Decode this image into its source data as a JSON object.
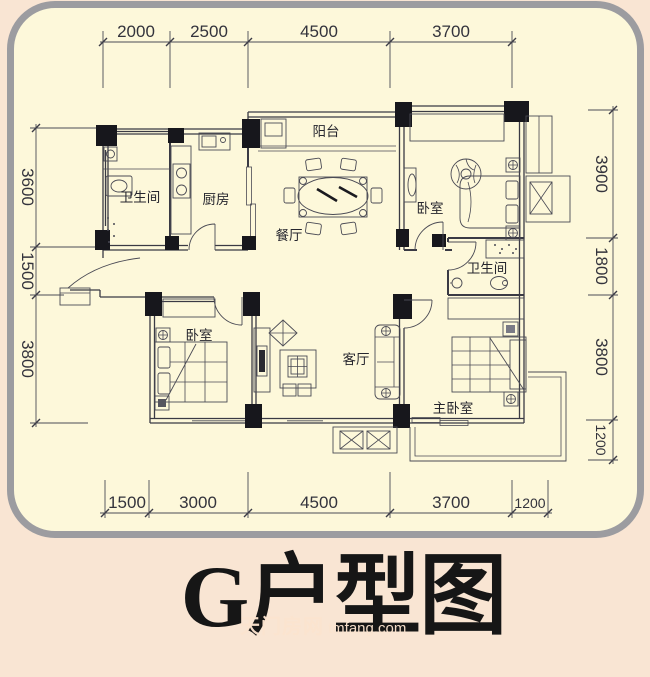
{
  "floorplan": {
    "title": "G户型图",
    "watermark": {
      "site_name": "天门房网",
      "site_url": "tmfang.com"
    },
    "rooms": [
      {
        "id": "balcony",
        "label": "阳台"
      },
      {
        "id": "bathroom-1",
        "label": "卫生间"
      },
      {
        "id": "kitchen",
        "label": "厨房"
      },
      {
        "id": "dining-room",
        "label": "餐厅"
      },
      {
        "id": "bedroom-1",
        "label": "卧室"
      },
      {
        "id": "bathroom-2",
        "label": "卫生间"
      },
      {
        "id": "bedroom-2",
        "label": "卧室"
      },
      {
        "id": "living-room",
        "label": "客厅"
      },
      {
        "id": "master-bedroom",
        "label": "主卧室"
      }
    ],
    "dimensions": {
      "top": [
        "2000",
        "2500",
        "4500",
        "3700"
      ],
      "bottom": [
        "1500",
        "3000",
        "4500",
        "3700",
        "1200"
      ],
      "left": [
        "3600",
        "1500",
        "3800"
      ],
      "right": [
        "3900",
        "1800",
        "3800",
        "1200"
      ]
    },
    "colors": {
      "outer_background": "#f9e5d3",
      "card_background": "#fdf8da",
      "card_border": "#9c9ca0",
      "line": "#3a3a44",
      "title_text": "#161616",
      "watermark_text": "#fce4cf"
    }
  }
}
